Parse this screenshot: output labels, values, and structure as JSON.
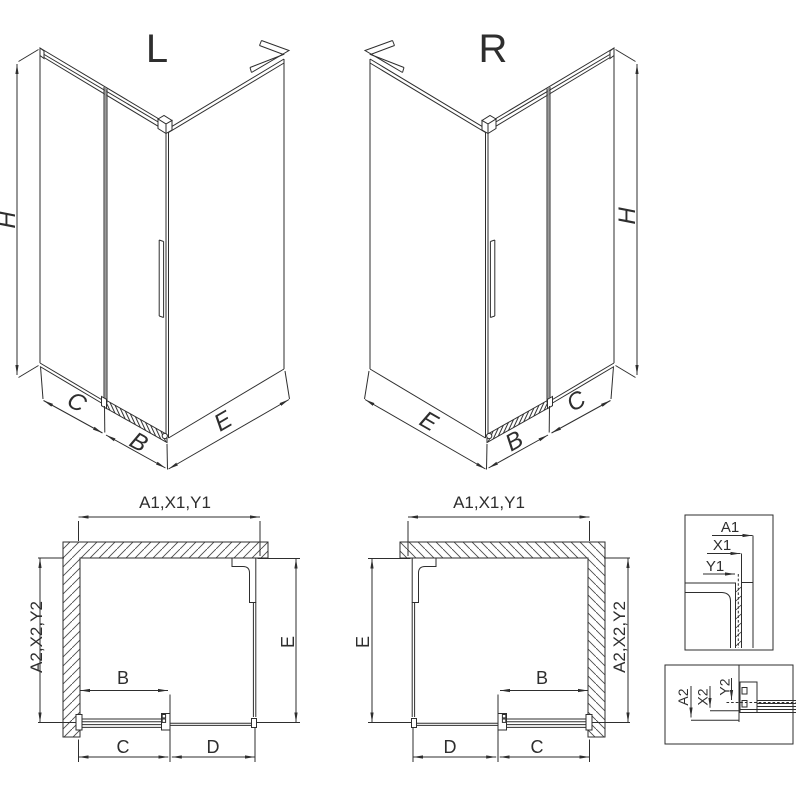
{
  "colors": {
    "line": "#2e2e2e",
    "gray_accent": "#9a9a9a",
    "background": "#ffffff"
  },
  "iso_left": {
    "title": "L",
    "dims": {
      "height": "H",
      "fixed": "C",
      "door": "B",
      "side": "E"
    }
  },
  "iso_right": {
    "title": "R",
    "dims": {
      "height": "H",
      "fixed": "C",
      "door": "B",
      "side": "E"
    }
  },
  "plan_left": {
    "dims": {
      "width": "A1,X1,Y1",
      "depth": "A2,X2,Y2",
      "side": "E",
      "door": "B",
      "fixed": "C",
      "opening": "D"
    }
  },
  "plan_right": {
    "dims": {
      "width": "A1,X1,Y1",
      "depth": "A2,X2,Y2",
      "side": "E",
      "door": "B",
      "fixed": "C",
      "opening": "D"
    }
  },
  "detail_width": {
    "dims": {
      "a": "A1",
      "x": "X1",
      "y": "Y1"
    }
  },
  "detail_depth": {
    "dims": {
      "a": "A2",
      "x": "X2",
      "y": "Y2"
    }
  }
}
